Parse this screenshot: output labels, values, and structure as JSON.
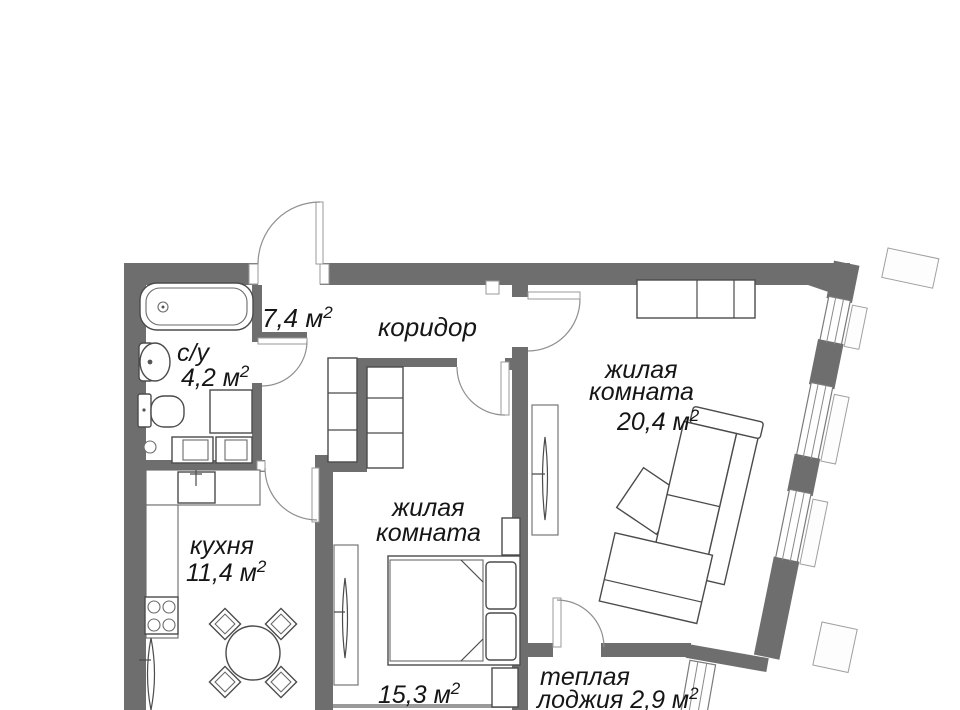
{
  "plan_type": "apartment-floor-plan",
  "colors": {
    "wall": "#6e6e6e",
    "line": "#4b4b4b",
    "bg": "#ffffff",
    "text": "#161616"
  },
  "labels": {
    "sup": "2",
    "corridor": {
      "area": "7,4 м",
      "name": "коридор"
    },
    "bathroom": {
      "name": "с/у",
      "area": "4,2 м"
    },
    "kitchen": {
      "name": "кухня",
      "area": "11,4 м"
    },
    "room_middle": {
      "name1": "жилая",
      "name2": "комната",
      "area": "15,3 м"
    },
    "room_right": {
      "name1": "жилая",
      "name2": "комната",
      "area": "20,4 м"
    },
    "loggia": {
      "name1": "теплая",
      "name2": "лоджия 2,9 м"
    }
  },
  "fixtures": [
    "bathtub",
    "wash-basin",
    "toilet",
    "bathroom-cabinet",
    "washing-machines",
    "corridor-wardrobe",
    "kitchen-counter",
    "kitchen-sink",
    "stove",
    "dining-table",
    "chairs",
    "radiator",
    "bed",
    "pillows",
    "nightstands",
    "tv-panels",
    "wardrobe",
    "sofa",
    "coffee-table"
  ]
}
